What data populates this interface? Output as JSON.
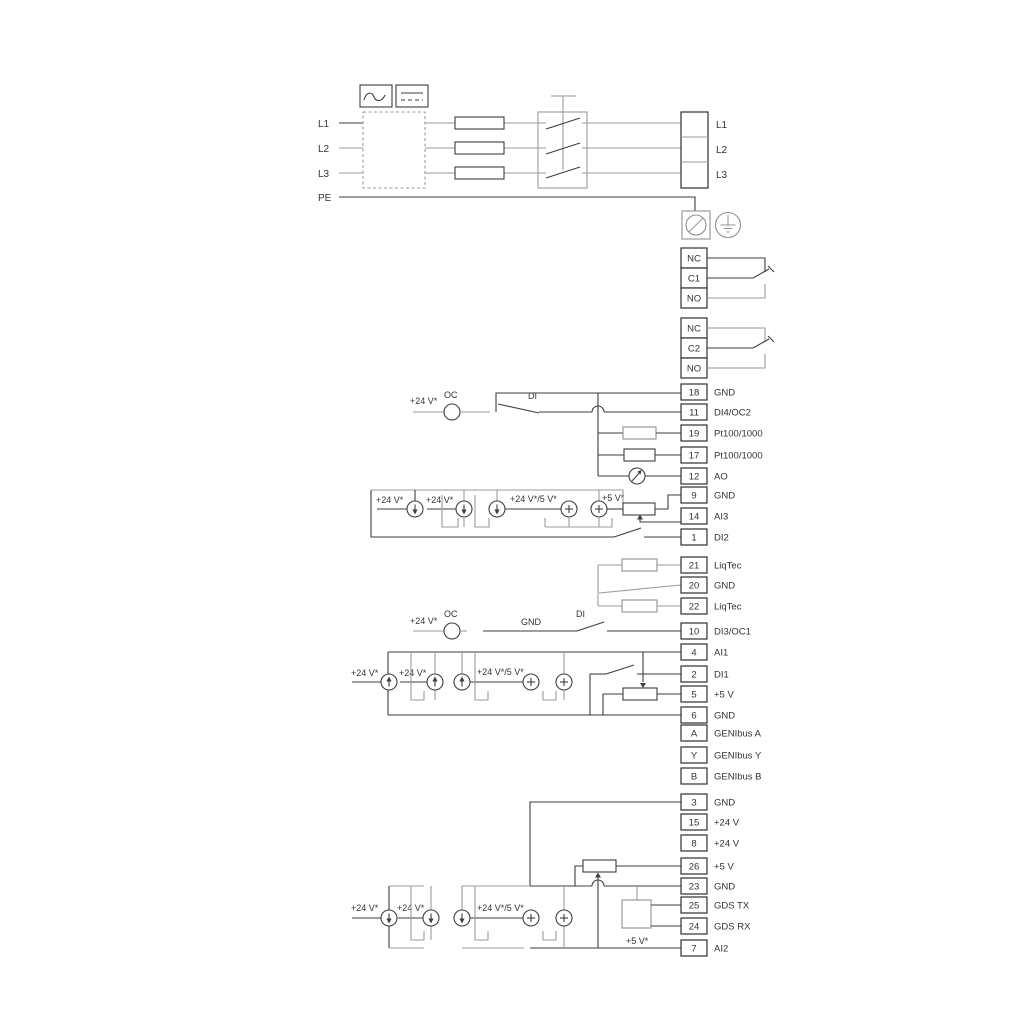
{
  "ann": {
    "v24": "+24 V*",
    "v24or5": "+24 V*/5 V*",
    "v5s": "+5 V*",
    "oc": "OC",
    "di": "DI",
    "gnd": "GND"
  },
  "mains": {
    "left": [
      "L1",
      "L2",
      "L3",
      "PE"
    ],
    "right": [
      "L1",
      "L2",
      "L3"
    ]
  },
  "r1": [
    "NC",
    "C1",
    "NO"
  ],
  "r2": [
    "NC",
    "C2",
    "NO"
  ],
  "gA": [
    {
      "n": "18",
      "label": "GND"
    },
    {
      "n": "11",
      "label": "DI4/OC2"
    },
    {
      "n": "19",
      "label": "Pt100/1000"
    },
    {
      "n": "17",
      "label": "Pt100/1000"
    },
    {
      "n": "12",
      "label": "AO"
    },
    {
      "n": "9",
      "label": "GND"
    },
    {
      "n": "14",
      "label": "AI3"
    },
    {
      "n": "1",
      "label": "DI2"
    }
  ],
  "lt": [
    {
      "n": "21",
      "label": "LiqTec"
    },
    {
      "n": "20",
      "label": "GND"
    },
    {
      "n": "22",
      "label": "LiqTec"
    }
  ],
  "gB": [
    {
      "n": "10",
      "label": "DI3/OC1"
    },
    {
      "n": "4",
      "label": "AI1"
    },
    {
      "n": "2",
      "label": "DI1"
    },
    {
      "n": "5",
      "label": "+5 V"
    },
    {
      "n": "6",
      "label": "GND"
    },
    {
      "n": "A",
      "label": "GENIbus A"
    },
    {
      "n": "Y",
      "label": "GENIbus Y"
    },
    {
      "n": "B",
      "label": "GENIbus B"
    }
  ],
  "gC": [
    {
      "n": "3",
      "label": "GND"
    },
    {
      "n": "15",
      "label": "+24 V"
    },
    {
      "n": "8",
      "label": "+24 V"
    },
    {
      "n": "26",
      "label": "+5 V"
    },
    {
      "n": "23",
      "label": "GND"
    },
    {
      "n": "25",
      "label": "GDS TX"
    },
    {
      "n": "24",
      "label": "GDS RX"
    },
    {
      "n": "7",
      "label": "AI2"
    }
  ]
}
